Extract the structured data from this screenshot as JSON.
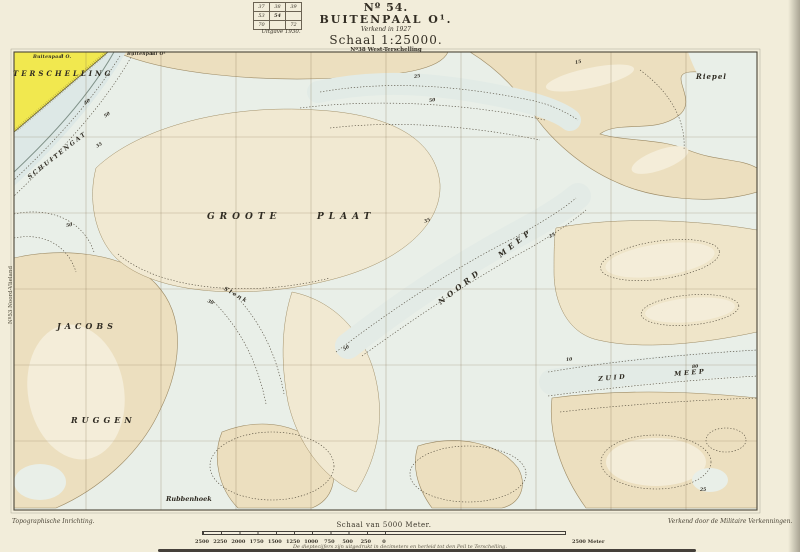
{
  "header": {
    "sheet_no": "Nº 54.",
    "title": "BUITENPAAL O¹.",
    "surveyed": "Verkend in 1927",
    "scale_title": "Schaal 1:25000.",
    "series": "Nº38 West-Terschelling",
    "edition": "Uitgave 1930.",
    "index_grid": [
      [
        "37",
        "38",
        "39"
      ],
      [
        "53",
        "54",
        ""
      ],
      [
        "70",
        "",
        "72"
      ]
    ]
  },
  "margins": {
    "left_vertical": "Nº53 Noord-Vlieland",
    "bottom_left": "Topographische Inrichting.",
    "bottom_right": "Verkend door de Militaire Verkenningen.",
    "depth_note": "De dieptecijfers zijn uitgedrukt in decimeters en herleid tot den Peil te Terschelling."
  },
  "scalebar": {
    "title": "Schaal van 5000 Meter.",
    "ticks": [
      "2500",
      "2250",
      "2000",
      "1750",
      "1500",
      "1250",
      "1000",
      "750",
      "500",
      "250",
      "0"
    ],
    "right_label": "2500 Meter"
  },
  "map_labels": {
    "terschelling": "TERSCHELLING",
    "buitenpaal_a": "Buitenpaal O.",
    "buitenpaal_b": "Buitenpaal O¹",
    "schuitengat": "SCHUITENGAT",
    "groote": "GROOTE",
    "plaat": "PLAAT",
    "noord": "NOORD",
    "meep_n": "MEEP",
    "slenk": "Slenk",
    "jacobs": "JACOBS",
    "ruggen": "RUGGEN",
    "rubbenhoek": "Rubbenhoek",
    "zuid": "ZUID",
    "meep_z": "MEEP",
    "riepel": "Riepel"
  },
  "depth_markers": [
    {
      "v": "40",
      "x": 84,
      "y": 103,
      "r": -35
    },
    {
      "v": "50",
      "x": 104,
      "y": 116,
      "r": -35
    },
    {
      "v": "35",
      "x": 96,
      "y": 146,
      "r": -30
    },
    {
      "v": "50",
      "x": 66,
      "y": 225,
      "r": -10
    },
    {
      "v": "25",
      "x": 414,
      "y": 76,
      "r": -8
    },
    {
      "v": "50",
      "x": 429,
      "y": 100,
      "r": -8
    },
    {
      "v": "15",
      "x": 575,
      "y": 62,
      "r": -12
    },
    {
      "v": "35",
      "x": 424,
      "y": 221,
      "r": -20
    },
    {
      "v": "25",
      "x": 549,
      "y": 236,
      "r": -25
    },
    {
      "v": "10",
      "x": 566,
      "y": 359,
      "r": -5
    },
    {
      "v": "80",
      "x": 692,
      "y": 366,
      "r": -5
    },
    {
      "v": "25",
      "x": 700,
      "y": 489,
      "r": 0
    },
    {
      "v": "50",
      "x": 343,
      "y": 349,
      "r": -30
    },
    {
      "v": "30",
      "x": 208,
      "y": 300,
      "r": 25
    }
  ],
  "colors": {
    "paper": "#f2edda",
    "water": "#e9efe8",
    "channel": "#dde8e6",
    "sand": "#ecdfbf",
    "sand_light": "#f1e9d2",
    "island_yellow": "#f1e84f",
    "frame": "#4a4538",
    "contour": "#4d4637"
  }
}
